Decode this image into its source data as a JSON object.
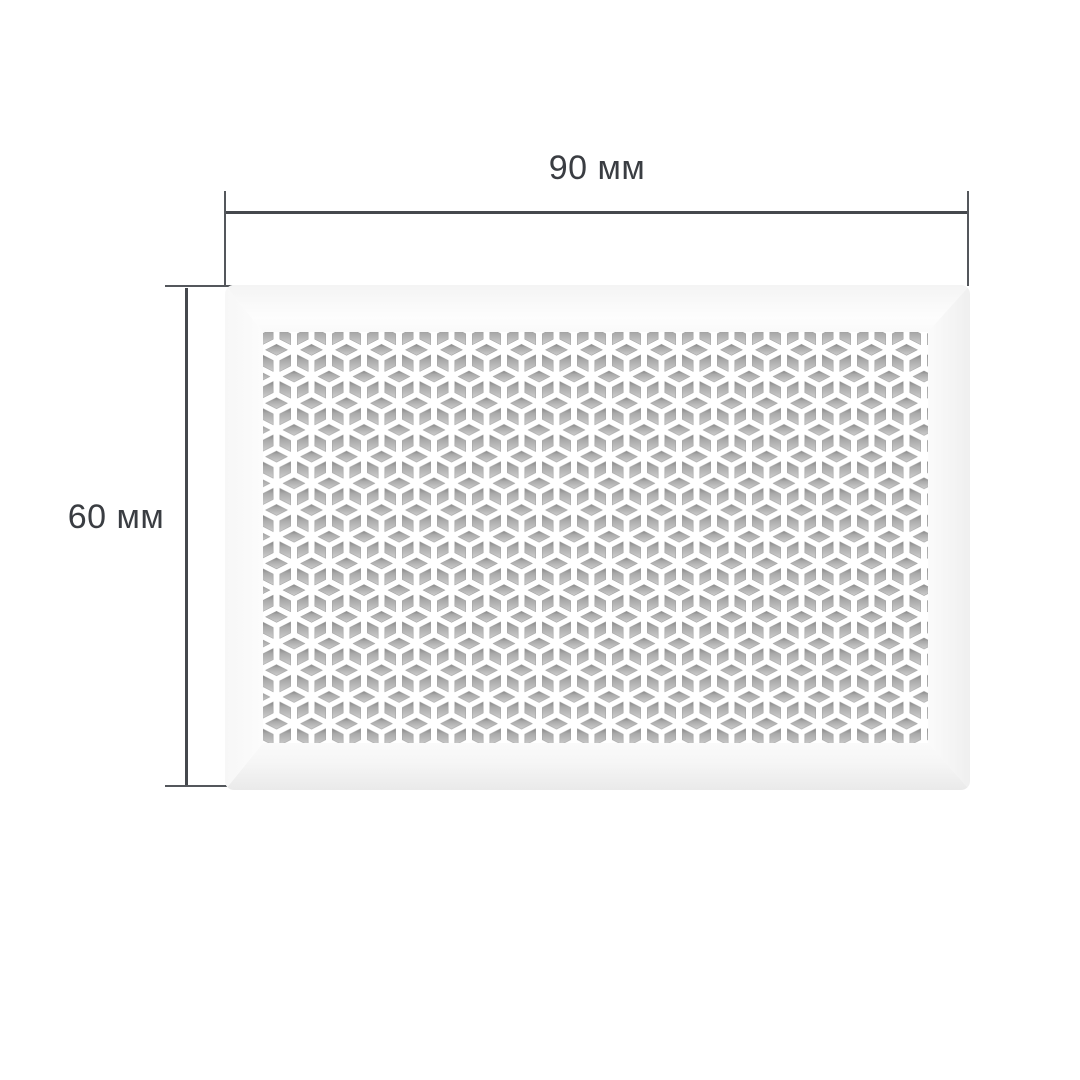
{
  "diagram": {
    "type": "product-dimension-drawing",
    "subject": "perforated-panel-grille",
    "pattern_name": "isometric-cubes",
    "width_dimension": {
      "label": "90 мм",
      "value": 90,
      "unit": "мм",
      "orientation": "horizontal"
    },
    "height_dimension": {
      "label": "60 мм",
      "value": 60,
      "unit": "мм",
      "orientation": "vertical"
    }
  },
  "colors": {
    "background": "#ffffff",
    "panel": "#ffffff",
    "dimension_line": "#45484d",
    "extension_line": "#54575c",
    "label_text": "#3a3d42",
    "hole_shadow_top": "#878787",
    "hole_shadow_bottom": "#cdcdcd",
    "bevel_shade": "#eaeaea"
  }
}
